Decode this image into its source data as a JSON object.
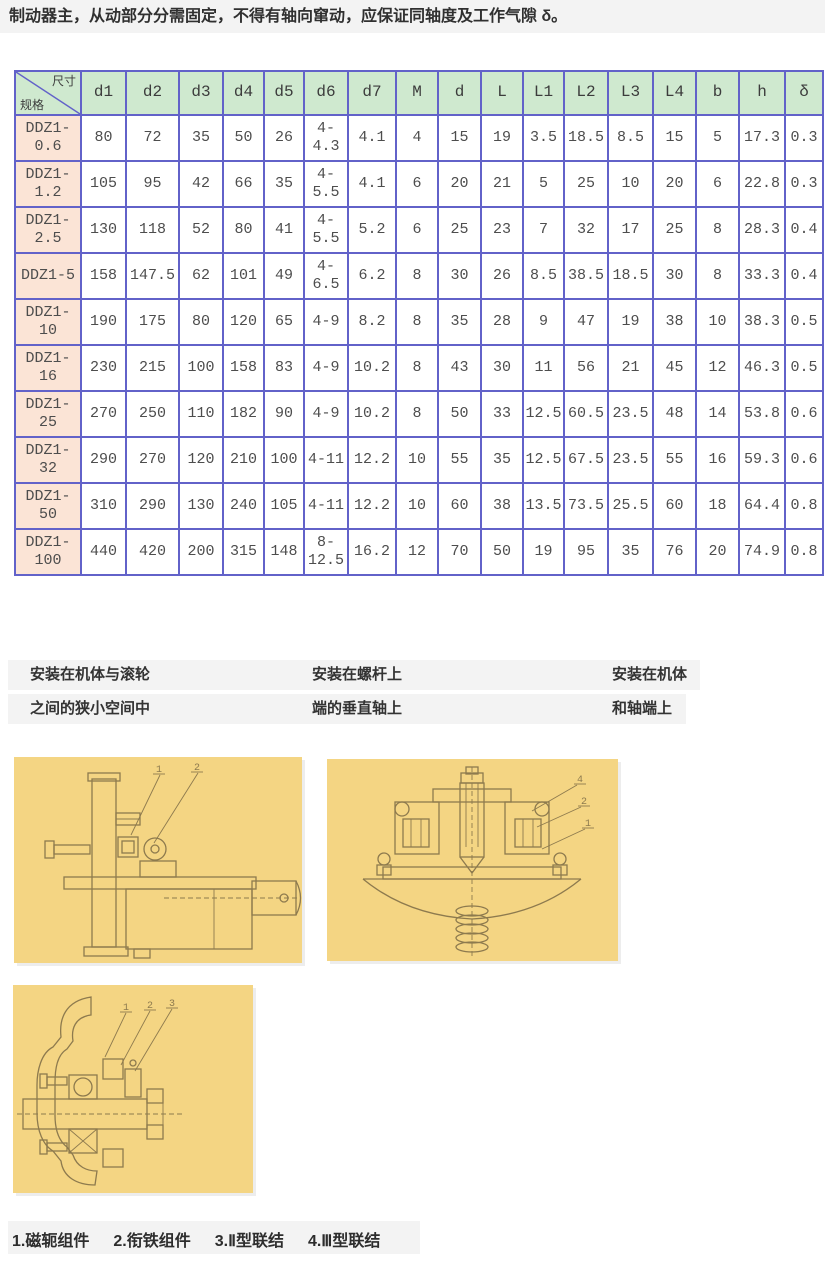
{
  "intro": {
    "text": "制动器主，从动部分分需固定，不得有轴向窜动，应保证同轴度及工作气隙 δ。"
  },
  "table": {
    "corner_top": "尺寸",
    "corner_bottom": "规格",
    "columns": [
      "d1",
      "d2",
      "d3",
      "d4",
      "d5",
      "d6",
      "d7",
      "M",
      "d",
      "L",
      "L1",
      "L2",
      "L3",
      "L4",
      "b",
      "h",
      "δ"
    ],
    "rows": [
      {
        "model": "DDZ1-0.6",
        "values": [
          "80",
          "72",
          "35",
          "50",
          "26",
          "4-4.3",
          "4.1",
          "4",
          "15",
          "19",
          "3.5",
          "18.5",
          "8.5",
          "15",
          "5",
          "17.3",
          "0.3"
        ]
      },
      {
        "model": "DDZ1-1.2",
        "values": [
          "105",
          "95",
          "42",
          "66",
          "35",
          "4-5.5",
          "4.1",
          "6",
          "20",
          "21",
          "5",
          "25",
          "10",
          "20",
          "6",
          "22.8",
          "0.3"
        ]
      },
      {
        "model": "DDZ1-2.5",
        "values": [
          "130",
          "118",
          "52",
          "80",
          "41",
          "4-5.5",
          "5.2",
          "6",
          "25",
          "23",
          "7",
          "32",
          "17",
          "25",
          "8",
          "28.3",
          "0.4"
        ]
      },
      {
        "model": "DDZ1-5",
        "values": [
          "158",
          "147.5",
          "62",
          "101",
          "49",
          "4-6.5",
          "6.2",
          "8",
          "30",
          "26",
          "8.5",
          "38.5",
          "18.5",
          "30",
          "8",
          "33.3",
          "0.4"
        ]
      },
      {
        "model": "DDZ1-10",
        "values": [
          "190",
          "175",
          "80",
          "120",
          "65",
          "4-9",
          "8.2",
          "8",
          "35",
          "28",
          "9",
          "47",
          "19",
          "38",
          "10",
          "38.3",
          "0.5"
        ]
      },
      {
        "model": "DDZ1-16",
        "values": [
          "230",
          "215",
          "100",
          "158",
          "83",
          "4-9",
          "10.2",
          "8",
          "43",
          "30",
          "11",
          "56",
          "21",
          "45",
          "12",
          "46.3",
          "0.5"
        ]
      },
      {
        "model": "DDZ1-25",
        "values": [
          "270",
          "250",
          "110",
          "182",
          "90",
          "4-9",
          "10.2",
          "8",
          "50",
          "33",
          "12.5",
          "60.5",
          "23.5",
          "48",
          "14",
          "53.8",
          "0.6"
        ]
      },
      {
        "model": "DDZ1-32",
        "values": [
          "290",
          "270",
          "120",
          "210",
          "100",
          "4-11",
          "12.2",
          "10",
          "55",
          "35",
          "12.5",
          "67.5",
          "23.5",
          "55",
          "16",
          "59.3",
          "0.6"
        ]
      },
      {
        "model": "DDZ1-50",
        "values": [
          "310",
          "290",
          "130",
          "240",
          "105",
          "4-11",
          "12.2",
          "10",
          "60",
          "38",
          "13.5",
          "73.5",
          "25.5",
          "60",
          "18",
          "64.4",
          "0.8"
        ]
      },
      {
        "model": "DDZ1-100",
        "values": [
          "440",
          "420",
          "200",
          "315",
          "148",
          "8-12.5",
          "16.2",
          "12",
          "70",
          "50",
          "19",
          "95",
          "35",
          "76",
          "20",
          "74.9",
          "0.8"
        ]
      }
    ]
  },
  "mount_captions": [
    {
      "line1": "安装在机体与滚轮",
      "line2": "之间的狭小空间中"
    },
    {
      "line1": "安装在螺杆上",
      "line2": "端的垂直轴上"
    },
    {
      "line1": "安装在机体",
      "line2": "和轴端上"
    }
  ],
  "figures": [
    {
      "name": "roller-gap-mount-drawing",
      "callouts": [
        "1",
        "2"
      ]
    },
    {
      "name": "vertical-screw-shaft-mount-drawing",
      "callouts": [
        "4",
        "2",
        "1"
      ]
    },
    {
      "name": "body-and-shaft-end-mount-drawing",
      "callouts": [
        "1",
        "2",
        "3"
      ]
    }
  ],
  "legend": {
    "items": [
      "1.磁轭组件",
      "2.衔铁组件",
      "3.Ⅱ型联结",
      "4.Ⅲ型联结"
    ]
  },
  "colors": {
    "table_border": "#6262c9",
    "header_bg": "#cfe9cf",
    "model_bg": "#fbe4d6",
    "image_bg": "#f4d583",
    "drawing_line": "#8d7a4e"
  }
}
